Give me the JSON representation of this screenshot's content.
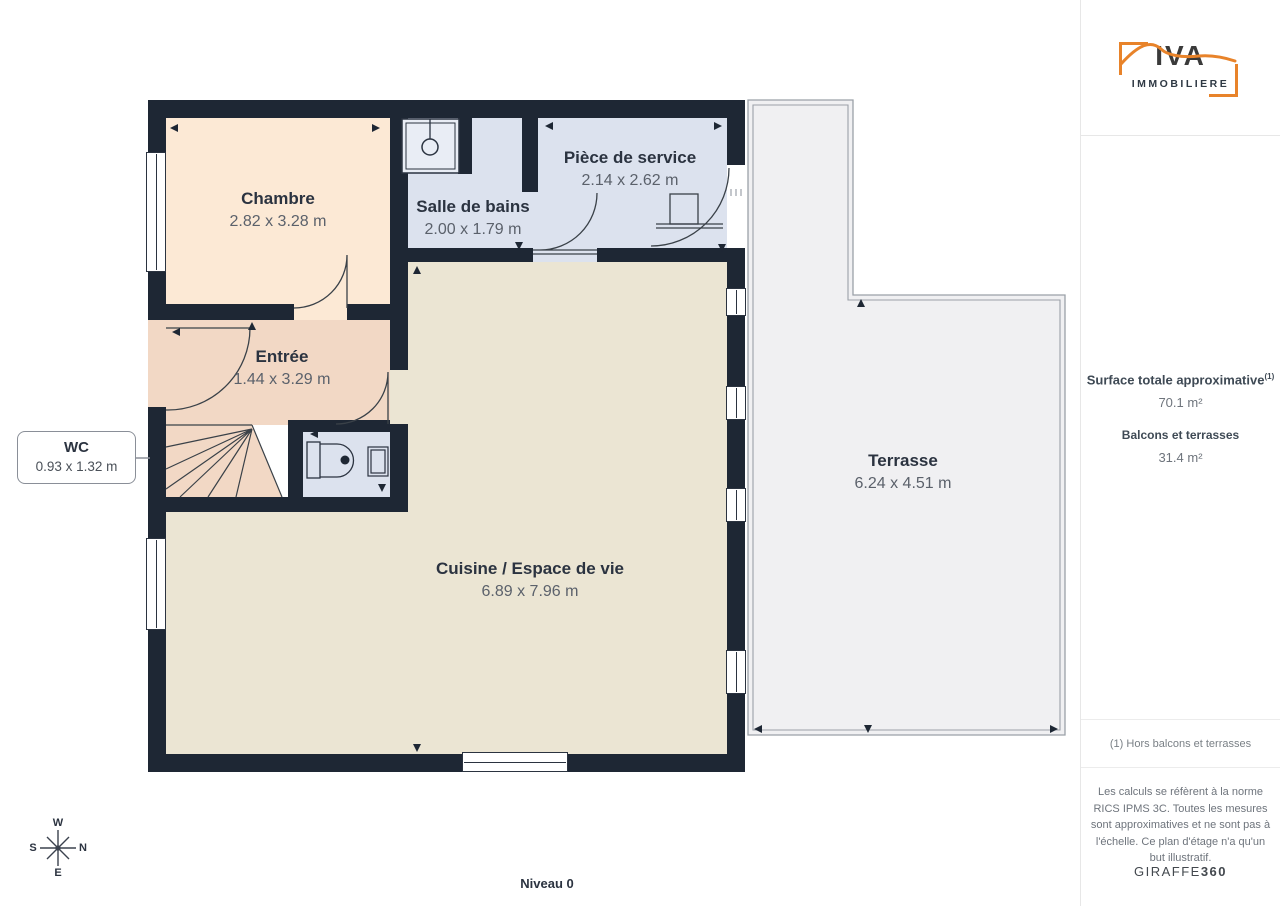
{
  "page": {
    "level_label": "Niveau 0"
  },
  "rooms": [
    {
      "name": "Chambre",
      "dims": "2.82 x 3.28 m"
    },
    {
      "name": "Salle de bains",
      "dims": "2.00 x 1.79 m"
    },
    {
      "name": "Pièce de service",
      "dims": "2.14 x 2.62 m"
    },
    {
      "name": "Entrée",
      "dims": "1.44 x 3.29 m"
    },
    {
      "name": "WC",
      "dims": "0.93 x 1.32 m"
    },
    {
      "name": "Cuisine / Espace de vie",
      "dims": "6.89 x 7.96 m"
    },
    {
      "name": "Terrasse",
      "dims": "6.24 x 4.51 m"
    }
  ],
  "compass": {
    "top": "W",
    "right": "N",
    "bottom": "E",
    "left": "S"
  },
  "sidebar": {
    "logo": {
      "brand": "IVA",
      "subtitle": "IMMOBILIERE"
    },
    "surface": {
      "title": "Surface totale approximative",
      "superscript": "(1)",
      "total_value": "70.1 m²",
      "balconies_label": "Balcons et terrasses",
      "balconies_value": "31.4 m²"
    },
    "footnote": "(1) Hors balcons et terrasses",
    "legal": "Les calculs se réfèrent à la norme RICS IPMS 3C. Toutes les mesures sont approximatives et ne sont pas à l'échelle. Ce plan d'étage n'a qu'un but illustratif.",
    "brand_footer": {
      "name": "GIRAFFE",
      "suffix": "360"
    }
  },
  "colors": {
    "wall": "#1e2734",
    "chambre": "#fce9d5",
    "entree": "#f2d8c5",
    "wet_rooms": "#dce2ee",
    "cuisine": "#ebe5d3",
    "terrasse": "#f0f0f2",
    "accent_orange": "#e8832a"
  }
}
